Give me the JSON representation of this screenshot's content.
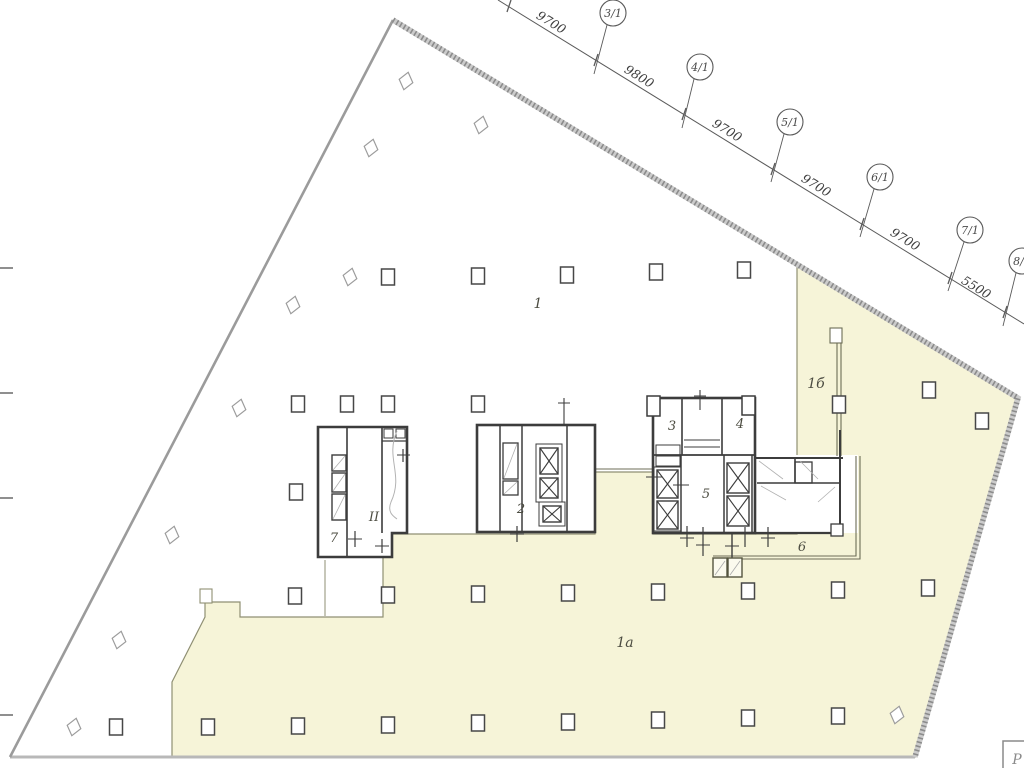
{
  "axes": [
    {
      "label": "3/1"
    },
    {
      "label": "4/1"
    },
    {
      "label": "5/1"
    },
    {
      "label": "6/1"
    },
    {
      "label": "7/1"
    },
    {
      "label": "8/1"
    }
  ],
  "dimensions": [
    "9700",
    "9800",
    "9700",
    "9700",
    "9700",
    "5500"
  ],
  "zones": {
    "zone_1": "1",
    "zone_1a": "1а",
    "zone_1b": "1б"
  },
  "rooms": {
    "room_2": "2",
    "room_3": "3",
    "room_4": "4",
    "room_5": "5",
    "room_6": "6",
    "room_7": "7"
  },
  "marks": {
    "riser": "II",
    "corner_stamp": "Р"
  },
  "colors": {
    "zone_highlight": "#f6f4d8",
    "wall": "#3c3c3c",
    "riser_red": "#c0402f",
    "boundary": "#9a9a9a"
  }
}
